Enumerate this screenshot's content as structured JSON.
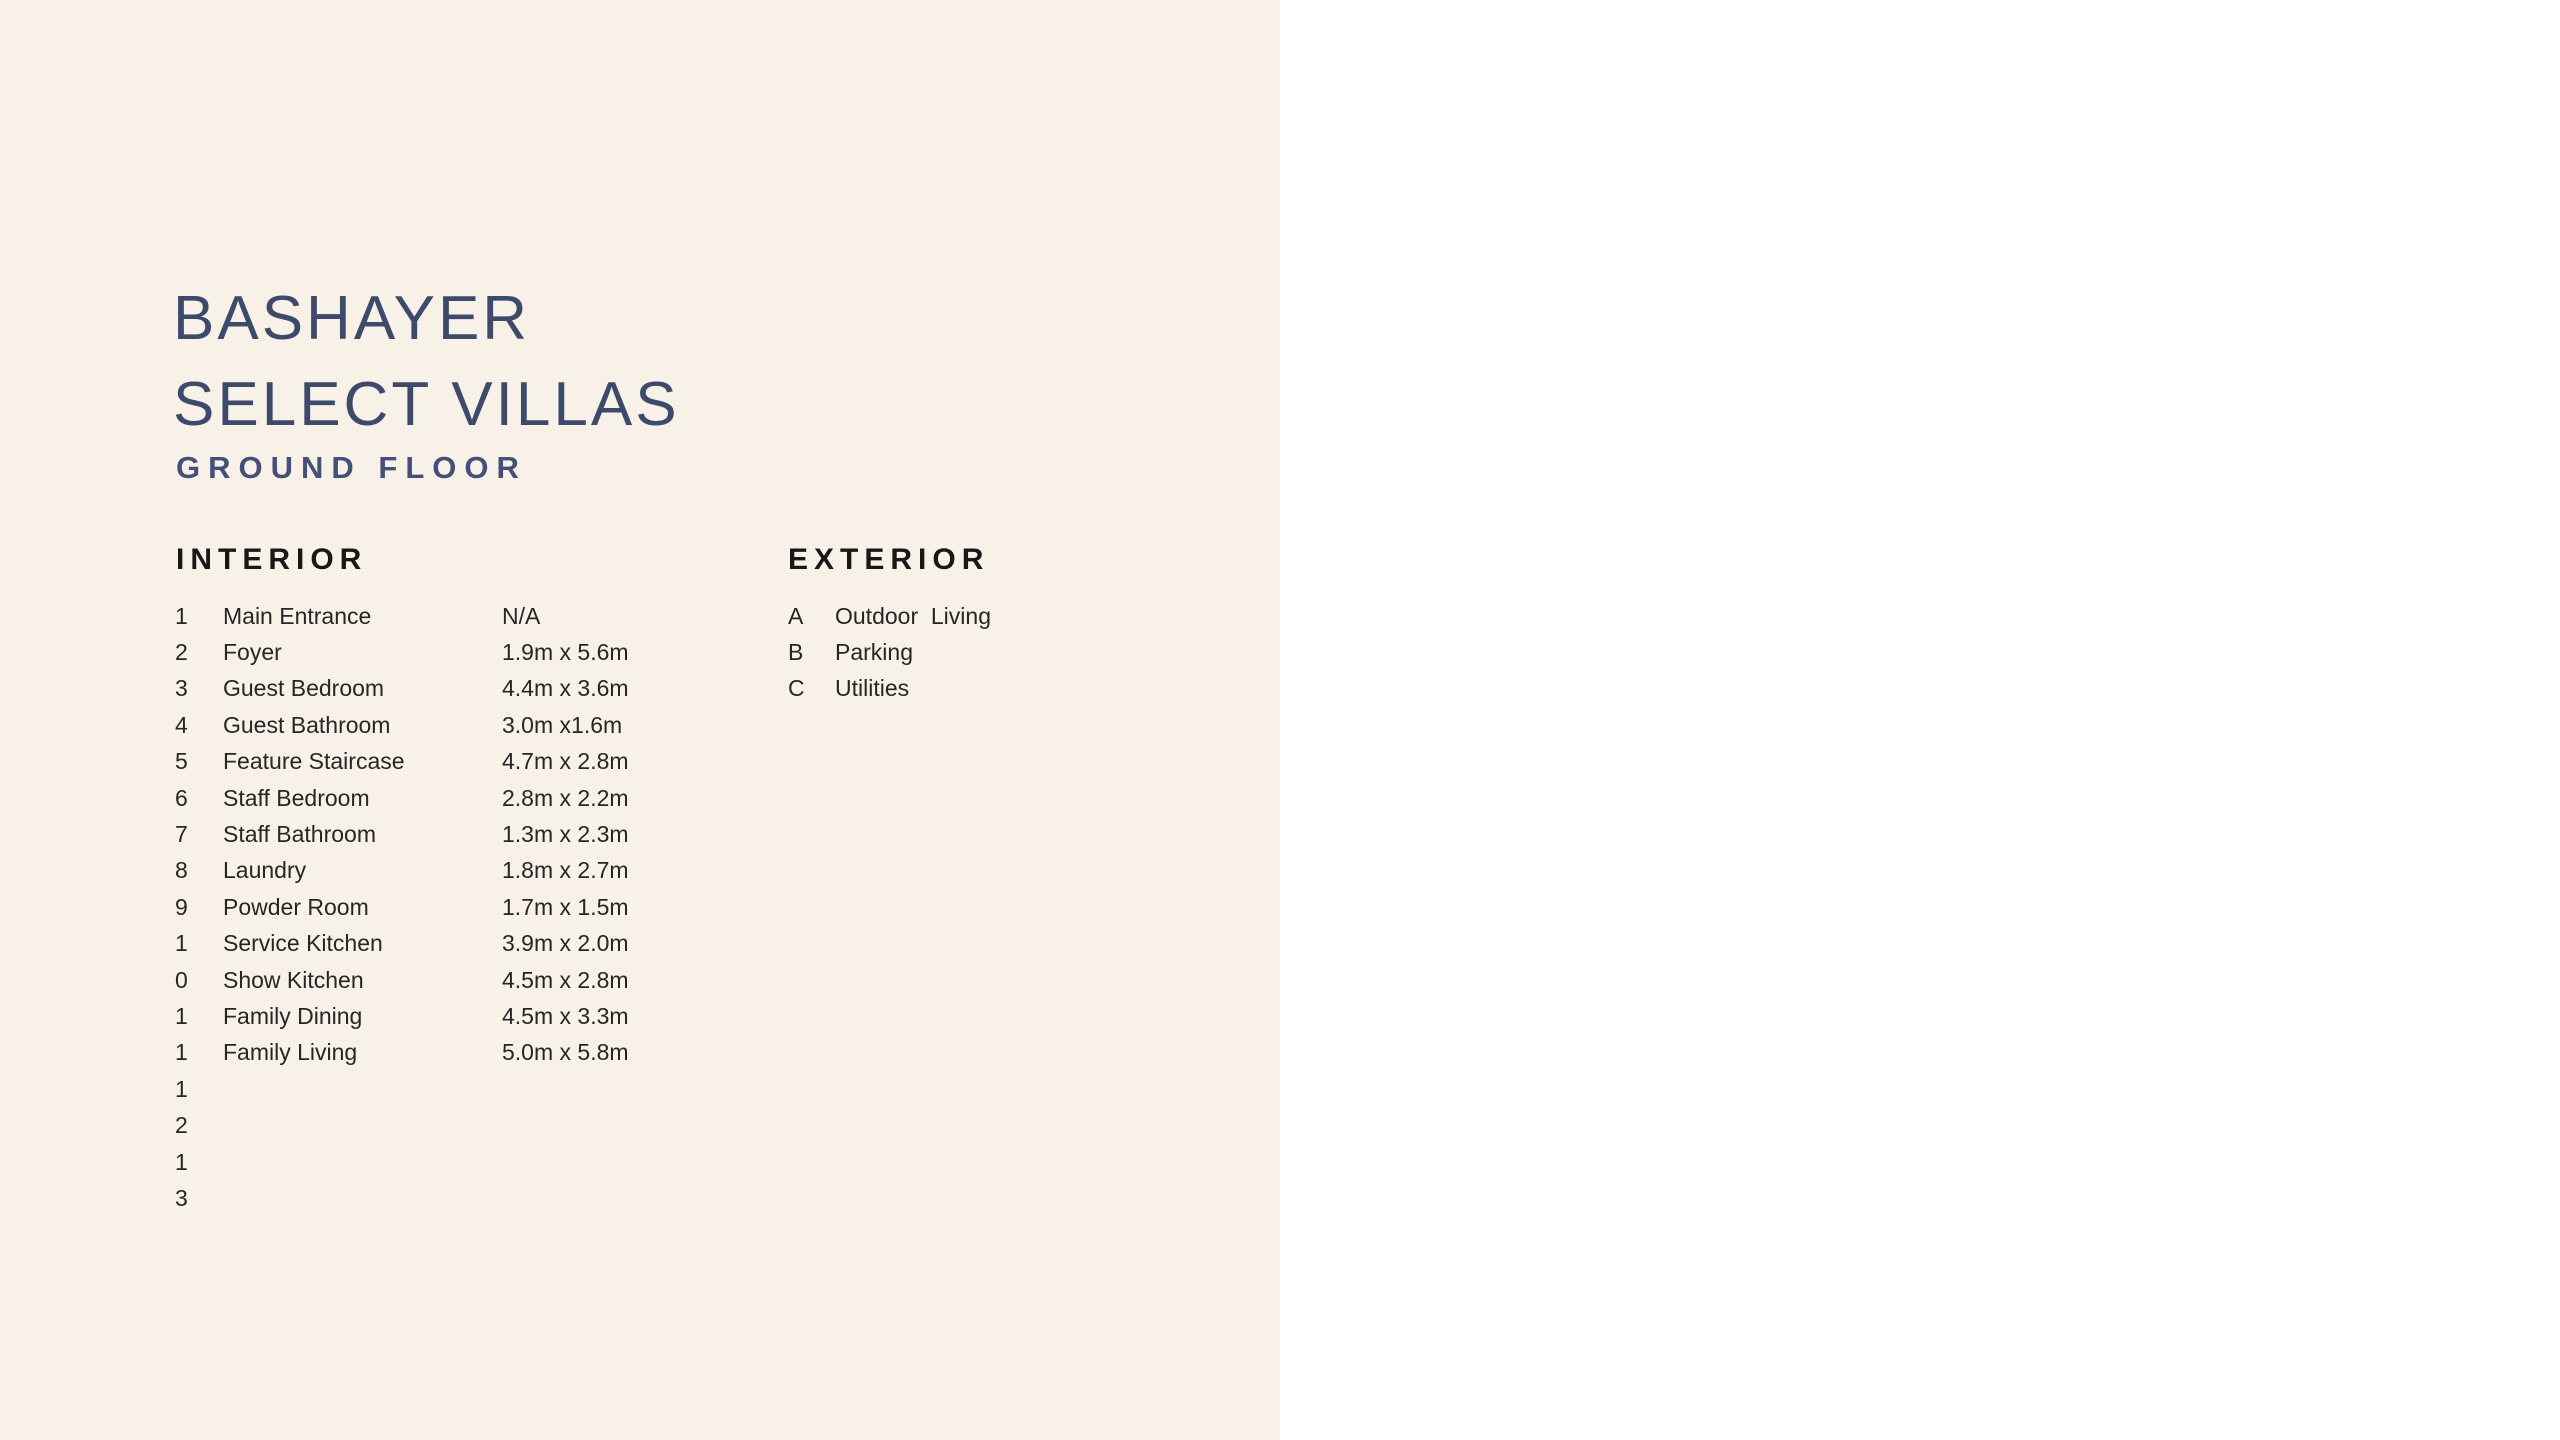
{
  "header": {
    "title_line1": "BASHAYER",
    "title_line2": "SELECT VILLAS",
    "subtitle": "GROUND FLOOR"
  },
  "interior": {
    "heading": "INTERIOR",
    "rows": [
      {
        "num": "1",
        "name": "Main Entrance",
        "dim": "N/A"
      },
      {
        "num": "2",
        "name": "Foyer",
        "dim": "1.9m x 5.6m"
      },
      {
        "num": "3",
        "name": "Guest Bedroom",
        "dim": "4.4m x 3.6m"
      },
      {
        "num": "4",
        "name": "Guest Bathroom",
        "dim": "3.0m x1.6m"
      },
      {
        "num": "5",
        "name": "Feature Staircase",
        "dim": "4.7m x 2.8m"
      },
      {
        "num": "6",
        "name": "Staff Bedroom",
        "dim": "2.8m x 2.2m"
      },
      {
        "num": "7",
        "name": "Staff Bathroom",
        "dim": "1.3m x 2.3m"
      },
      {
        "num": "8",
        "name": "Laundry",
        "dim": "1.8m x 2.7m"
      },
      {
        "num": "9",
        "name": "Powder Room",
        "dim": "1.7m x 1.5m"
      },
      {
        "num": "1",
        "name": "Service Kitchen",
        "dim": "3.9m x 2.0m"
      },
      {
        "num": "0",
        "name": "Show Kitchen",
        "dim": "4.5m x 2.8m"
      },
      {
        "num": "1",
        "name": "Family Dining",
        "dim": "4.5m x 3.3m"
      },
      {
        "num": "1",
        "name": "Family Living",
        "dim": "5.0m x 5.8m"
      },
      {
        "num": "1",
        "name": "",
        "dim": ""
      },
      {
        "num": "2",
        "name": "",
        "dim": ""
      },
      {
        "num": "1",
        "name": "",
        "dim": ""
      },
      {
        "num": "3",
        "name": "",
        "dim": ""
      }
    ]
  },
  "exterior": {
    "heading": "EXTERIOR",
    "rows": [
      {
        "num": "A",
        "name": "Outdoor  Living"
      },
      {
        "num": "B",
        "name": "Parking"
      },
      {
        "num": "C",
        "name": "Utilities"
      }
    ]
  },
  "plan": {
    "dim_width": "16 m",
    "dim_height": "28 m",
    "labels": [
      {
        "text": "1"
      },
      {
        "text": "2"
      },
      {
        "text": "3"
      },
      {
        "text": "4"
      },
      {
        "text": "5"
      },
      {
        "text": "6"
      },
      {
        "text": "7"
      },
      {
        "text": "8"
      },
      {
        "text": "9"
      },
      {
        "text": "10"
      },
      {
        "text": "11"
      },
      {
        "text": "12"
      },
      {
        "text": "13"
      },
      {
        "text": "A"
      },
      {
        "text": "B"
      },
      {
        "text": "C"
      },
      {
        "text": "C"
      }
    ],
    "colors": {
      "grass": "#b7bfa0",
      "lawn": "#aab38d",
      "terrace": "#d9d2c6",
      "floor": "#ece7dd",
      "bath_brown": "#b2977a",
      "garage": "#ababab",
      "wall": "#161616",
      "tree": "#9fb476"
    }
  },
  "footer": {
    "brand_primary": "BASHAYER",
    "brand_secondary": "MOƆON",
    "page_number": "38"
  }
}
